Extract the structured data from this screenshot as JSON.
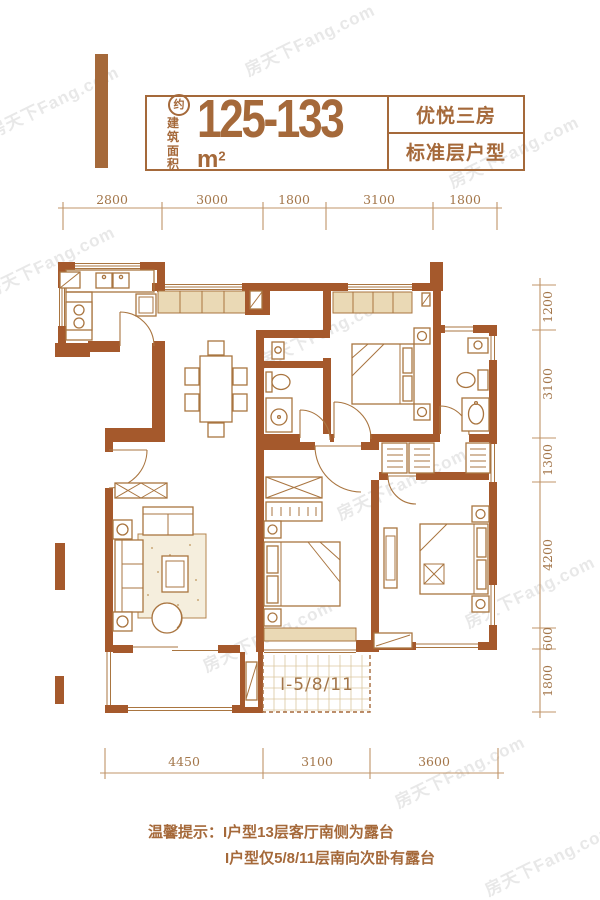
{
  "header": {
    "circle_label": "约",
    "area_label_line1": "建筑",
    "area_label_line2": "面积",
    "area_value": "125-133",
    "area_unit_letter": "m",
    "area_unit_sup": "2",
    "type_name": "优悦三房",
    "type_floor": "标准层户型"
  },
  "dimensions": {
    "top": [
      "2800",
      "3000",
      "1800",
      "3100",
      "1800"
    ],
    "right": [
      "1200",
      "3100",
      "1300",
      "4200",
      "600",
      "1800"
    ],
    "bottom": [
      "4450",
      "3100",
      "3600"
    ]
  },
  "plan": {
    "unit_label": "I-5/8/11"
  },
  "tips": {
    "line1": "温馨提示：I户型13层客厅南侧为露台",
    "line2": "I户型仅5/8/11层南向次卧有露台"
  },
  "watermark": {
    "text": "房天下Fang.com"
  },
  "colors": {
    "wall": "#a5592c",
    "accent": "#a5693a",
    "beige": "#ead9b5",
    "dim_line": "#c09468",
    "dim_text": "#a3764a"
  }
}
